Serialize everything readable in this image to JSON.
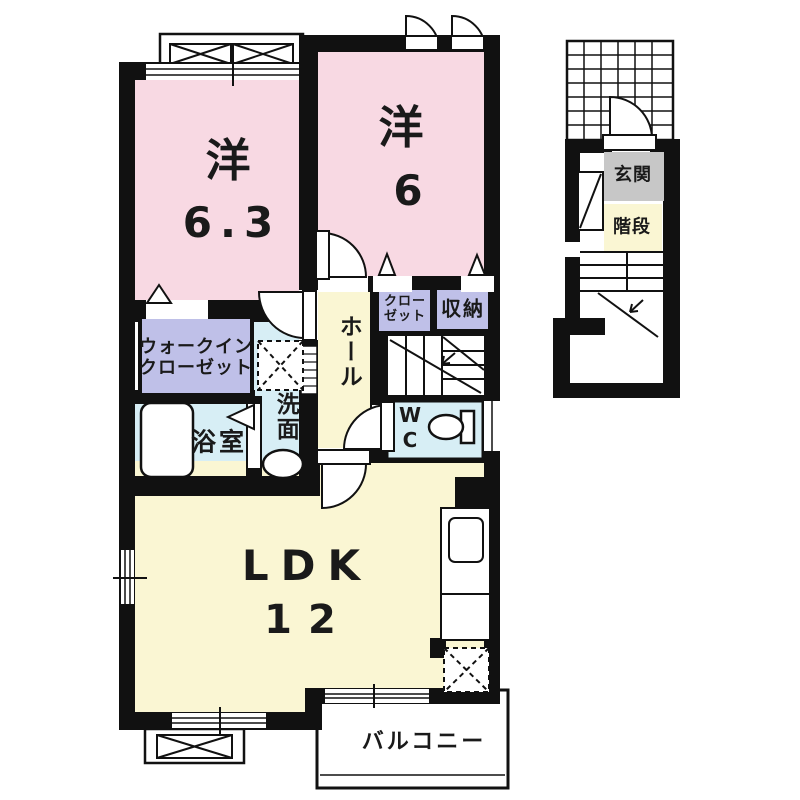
{
  "title": "2LDK apartment floor plan",
  "colors": {
    "bedroom_pink": "#f8d9e3",
    "closet_lavender": "#bfc0e8",
    "wet_blue": "#d7eef5",
    "living_cream": "#faf6d3",
    "entry_gray": "#c7c7c7",
    "wall_black": "#111111",
    "line_black": "#111111",
    "paper_white": "#ffffff"
  },
  "second_floor": {
    "bedroom1": {
      "kanji": "洋",
      "size": "6.3"
    },
    "bedroom2": {
      "kanji": "洋",
      "size": "6"
    },
    "walk_in_closet": {
      "line1": "ウォークイン",
      "line2": "クローゼット"
    },
    "hall": {
      "label": "ホール"
    },
    "closet": {
      "line1": "クロー",
      "line2": "ゼット"
    },
    "storage": {
      "label": "収納"
    },
    "washroom": {
      "label": "洗面"
    },
    "bathroom": {
      "label": "浴室"
    },
    "wc": {
      "line1": "W",
      "line2": "C"
    },
    "ldk": {
      "label": "LDK",
      "size": "12"
    },
    "balcony": {
      "label": "バルコニー"
    }
  },
  "first_floor": {
    "entrance": {
      "label": "玄関"
    },
    "stairs": {
      "label": "階段"
    }
  }
}
